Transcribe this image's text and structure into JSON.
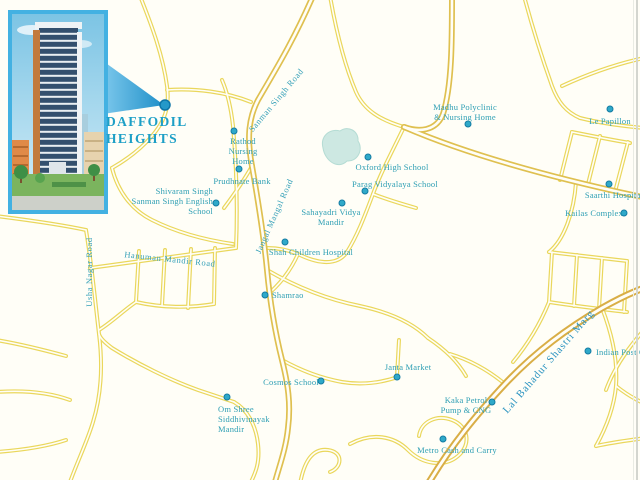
{
  "project": {
    "name_line1": "DAFFODIL",
    "name_line2": "HEIGHTS",
    "inset_alt": "Daffodil Heights tower rendering"
  },
  "colors": {
    "background": "#fffef7",
    "label_teal": "#2f9fb4",
    "road_minor": "#ead75c",
    "road_major": "#dfc050",
    "road_lbs": "#d9ae46",
    "pond": "#cde8e2",
    "callout_blue": "#2e9ed2",
    "inset_border": "#43b1e2",
    "marker": "#2fa9c9"
  },
  "map": {
    "landmark_dot": {
      "x": 165,
      "y": 105
    },
    "pois": [
      {
        "id": "rathod-nursing-home",
        "label": "Rathod\nNursing\nHome",
        "x": 243,
        "y": 136,
        "align": "center",
        "dot": {
          "x": 234,
          "y": 131
        }
      },
      {
        "id": "prudhnate-bank",
        "label": "Prudhnate Bank",
        "x": 242,
        "y": 176,
        "align": "center",
        "dot": {
          "x": 239,
          "y": 169
        }
      },
      {
        "id": "shivaram-singh-school",
        "label": "Shivaram Singh\nSanman Singh English\nSchool",
        "x": 213,
        "y": 186,
        "align": "right",
        "dot": {
          "x": 216,
          "y": 203
        }
      },
      {
        "id": "oxford-high-school",
        "label": "Oxford High School",
        "x": 392,
        "y": 162,
        "align": "center",
        "dot": {
          "x": 368,
          "y": 157
        }
      },
      {
        "id": "parag-vidyalaya-school",
        "label": "Parag Vidyalaya School",
        "x": 395,
        "y": 179,
        "align": "center",
        "dot": {
          "x": 365,
          "y": 191
        }
      },
      {
        "id": "sahayadri-vidya-mandir",
        "label": "Sahayadri Vidya\nMandir",
        "x": 331,
        "y": 207,
        "align": "center",
        "dot": {
          "x": 342,
          "y": 203
        }
      },
      {
        "id": "shah-children-hospital",
        "label": "Shah Children Hospital",
        "x": 311,
        "y": 247,
        "align": "center",
        "dot": {
          "x": 285,
          "y": 242
        }
      },
      {
        "id": "shamrao",
        "label": "Shamrao",
        "x": 272,
        "y": 290,
        "align": "left",
        "dot": {
          "x": 265,
          "y": 295
        }
      },
      {
        "id": "cosmos-school",
        "label": "Cosmos School",
        "x": 291,
        "y": 377,
        "align": "center",
        "dot": {
          "x": 321,
          "y": 381
        }
      },
      {
        "id": "om-shree-siddhivinayak-mandir",
        "label": "Om Shree\nSiddhivinayak\nMandir",
        "x": 218,
        "y": 404,
        "align": "left",
        "dot": {
          "x": 227,
          "y": 397
        }
      },
      {
        "id": "janta-market",
        "label": "Janta Market",
        "x": 408,
        "y": 362,
        "align": "center",
        "dot": {
          "x": 397,
          "y": 377
        }
      },
      {
        "id": "madhu-polyclinic",
        "label": "Madhu Polyclinic\n& Nursing Home",
        "x": 465,
        "y": 102,
        "align": "center",
        "dot": {
          "x": 468,
          "y": 124
        }
      },
      {
        "id": "le-papillon",
        "label": "Le Papillon",
        "x": 610,
        "y": 116,
        "align": "center",
        "dot": {
          "x": 610,
          "y": 109
        }
      },
      {
        "id": "saarthi-hospital",
        "label": "Saarthi Hospital",
        "x": 614,
        "y": 190,
        "align": "center",
        "dot": {
          "x": 609,
          "y": 184
        }
      },
      {
        "id": "kailas-complex",
        "label": "Kailas Complex",
        "x": 594,
        "y": 208,
        "align": "center",
        "dot": {
          "x": 624,
          "y": 213
        }
      },
      {
        "id": "indian-post-office",
        "label": "Indian Post Off",
        "x": 596,
        "y": 347,
        "align": "left",
        "dot": {
          "x": 588,
          "y": 351
        }
      },
      {
        "id": "kaka-petrol-pump",
        "label": "Kaka Petrol\nPump & CNG",
        "x": 466,
        "y": 395,
        "align": "center",
        "dot": {
          "x": 492,
          "y": 402
        }
      },
      {
        "id": "metro-cash-and-carry",
        "label": "Metro Cash and Carry",
        "x": 457,
        "y": 445,
        "align": "center",
        "dot": {
          "x": 443,
          "y": 439
        }
      }
    ],
    "road_labels": [
      {
        "id": "sanman-singh-road",
        "label": "Sanman Singh Road",
        "x": 276,
        "y": 100,
        "angle": -50,
        "major": false
      },
      {
        "id": "jangal-mangal-road",
        "label": "Jangal Mangal Road",
        "x": 274,
        "y": 216,
        "angle": -66,
        "major": false
      },
      {
        "id": "hanuman-mandir-road",
        "label": "Hanuman Mandir Road",
        "x": 170,
        "y": 259,
        "angle": 6,
        "major": false
      },
      {
        "id": "usha-nagar-road",
        "label": "Usha Nagar Road",
        "x": 89,
        "y": 272,
        "angle": -90,
        "major": false
      },
      {
        "id": "lal-bahadur-shastri-marg",
        "label": "Lal Bahadur Shastri Marg",
        "x": 549,
        "y": 362,
        "angle": -49,
        "major": true
      }
    ]
  }
}
